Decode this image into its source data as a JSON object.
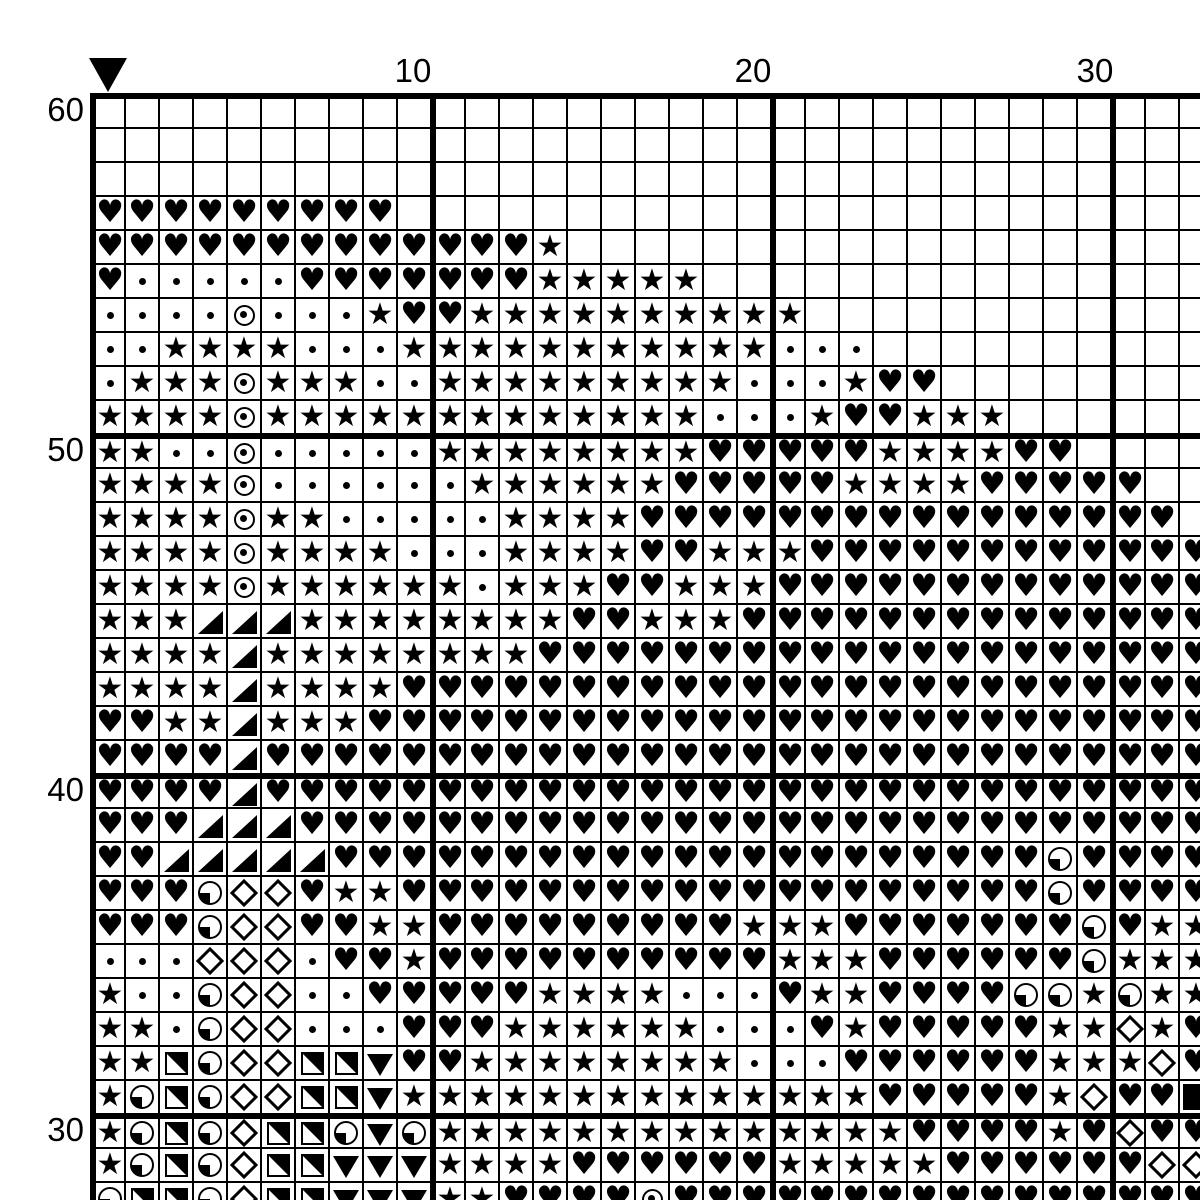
{
  "chart_type": "cross-stitch-pattern-grid",
  "axes": {
    "column_labels": [
      {
        "text": "10",
        "column": 10
      },
      {
        "text": "20",
        "column": 20
      },
      {
        "text": "30",
        "column": 30
      }
    ],
    "row_labels": [
      {
        "text": "60",
        "row": 60
      },
      {
        "text": "50",
        "row": 50
      },
      {
        "text": "40",
        "row": 40
      },
      {
        "text": "30",
        "row": 30
      }
    ]
  },
  "marker": {
    "name": "center-marker",
    "shape": "down-triangle",
    "color": "#000000"
  },
  "grid": {
    "visible_columns": 33,
    "visible_rows": 33,
    "first_row_number": 60,
    "last_row_number": 28,
    "cell_size_px": 34,
    "thick_line_every": 10,
    "line_color": "#000000",
    "background_color": "#ffffff",
    "symbols": {
      "H": {
        "name": "heart",
        "glyph": "♥"
      },
      "S": {
        "name": "star",
        "glyph": "★"
      },
      "d": {
        "name": "dot",
        "glyph": ""
      },
      "O": {
        "name": "circle-dot",
        "glyph": ""
      },
      "T": {
        "name": "corner-triangle-lower-right",
        "glyph": ""
      },
      "Q": {
        "name": "quarter-circle-lower-left",
        "glyph": ""
      },
      "D": {
        "name": "diamond-outline",
        "glyph": ""
      },
      "U": {
        "name": "half-square-upper-right",
        "glyph": ""
      },
      "V": {
        "name": "down-triangle",
        "glyph": ""
      },
      "B": {
        "name": "filled-square",
        "glyph": ""
      },
      ".": {
        "name": "empty",
        "glyph": ""
      }
    },
    "rows_data": [
      ".................................",
      ".................................",
      ".................................",
      "HHHHHHHHH........................",
      "HHHHHHHHHHHHHS...................",
      "HdddddHHHHHHHSSSSS...............",
      "ddddOdddSHHSSSSSSSSSS............",
      "ddSSSSdddSSSSSSSSSSSddd..........",
      "dSSSOSSSddSSSSSSSSSdddSHH........",
      "SSSSOSSSSSSSSSSSSSdddSHHSSS......",
      "SSddOdddddSSSSSSSSHHHHHSSSSHH....",
      "SSSSOddddddSSSSSSHHHHHSSSSHHHHH..",
      "SSSSOSSdddddSSSSHHHHHHHHHHHHHHHH.",
      "SSSSOSSSSdddSSSSHHSSSHHHHHHHHHHHH",
      "SSSSOSSSSSSdSSSHHSSSHHHHHHHHHHHHH",
      "SSSTTTSSSSSSSSHHSSSHHHHHHHHHHHHHH",
      "SSSSTSSSSSSSSHHHHHHHHHHHHHHHHHHHH",
      "SSSSTSSSSHHHHHHHHHHHHHHHHHHHHHHHH",
      "HHSSTSSSHHHHHHHHHHHHHHHHHHHHHHHHH",
      "HHHHTHHHHHHHHHHHHHHHHHHHHHHHHHHHH",
      "HHHHTHHHHHHHHHHHHHHHHHHHHHHHHHHHH",
      "HHHTTTHHHHHHHHHHHHHHHHHHHHHHHHHHH",
      "HHTTTTTHHHHHHHHHHHHHHHHHHHHHQHHHH",
      "HHHQDDHSSHHHHHHHHHHHHHHHHHHHQHHHH",
      "HHHQDDHHSSHHHHHHHHHSSSHHHHHHHQHSS",
      "dddDDDdHHSHHHHHHHHHHSSSHHHHHHQSSS",
      "SddQDDddHHHHHSSSSdddHSSHHHHQQSQSS",
      "SSdQDDdddHHHSSSSSSdddHSHHHHHSSDSH",
      "SSUQDDUUVHHSSSSSSSSdddHHHHHHSSSDH",
      "SQUQDDUUVSSSSSSSSSSSSSSHHHHHSDHHB",
      "SQUQDUUQVQSSSSSSSSSSSSSSHHHHSHDHH",
      "SQUQDUUVVVSSSSHHHHHHSSSSSHHHHHHDD",
      "QUUQDUUVVVSSHHHHOHHHHHHHHHHHHHHHH"
    ]
  }
}
